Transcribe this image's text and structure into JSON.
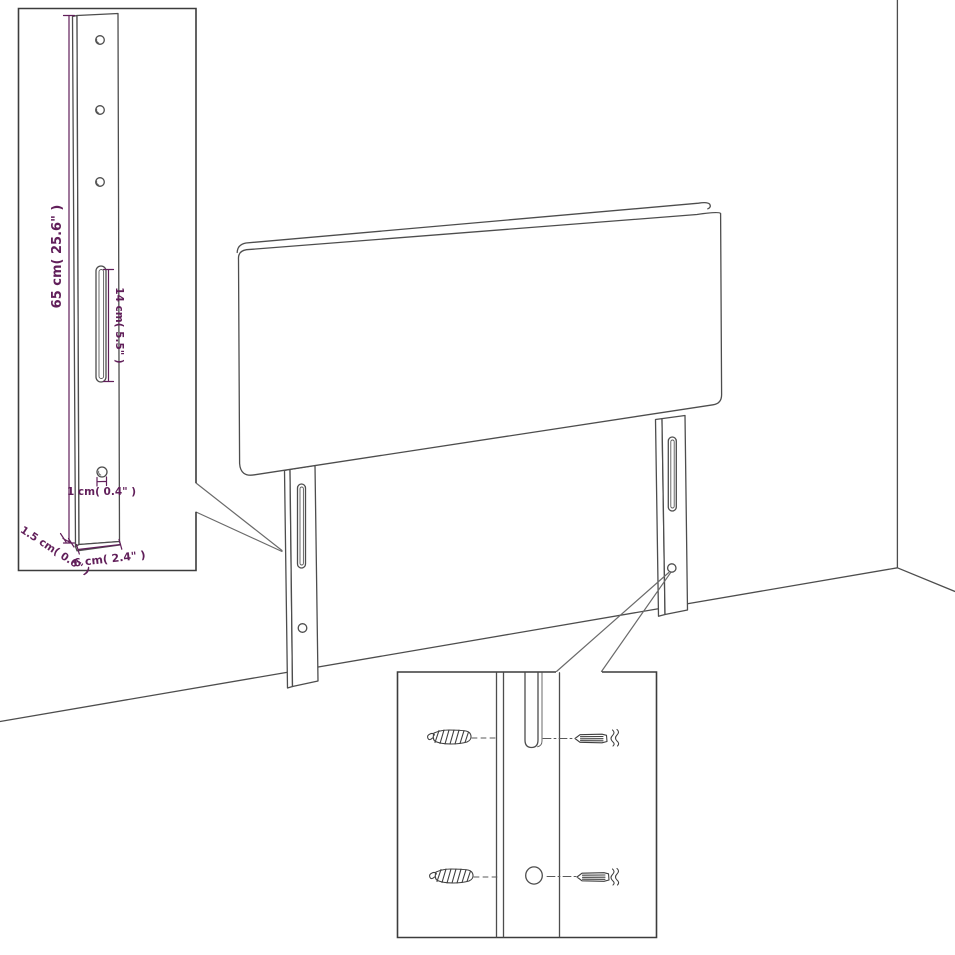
{
  "diagram": {
    "kind": "furniture-dimension-drawing",
    "subject": "upholstered headboard with two slotted mounting legs shown in a room corner, with a leg-detail inset and a wall-mounting hardware inset"
  },
  "colors": {
    "background": "#ffffff",
    "outline": "#4d4d4d",
    "inset_border": "#3c3c3c",
    "dimension": "#611f5a"
  },
  "leg_detail_inset": {
    "labels": {
      "leg_height": "65 cm( 25.6\" )",
      "slot_length": "14 cm( 5.5\" )",
      "hole_diameter": "1 cm( 0.4\" )",
      "leg_thickness": "1.5 cm( 0.6\" )",
      "leg_width": "6 cm( 2.4\" )"
    }
  }
}
